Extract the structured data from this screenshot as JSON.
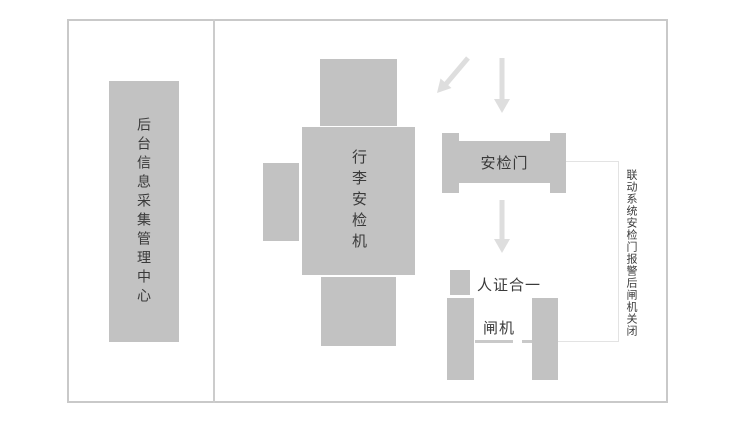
{
  "diagram": {
    "title_context": "security-check-flow-diagram",
    "left_panel": {
      "label": "后台信息采集管理中心"
    },
    "baggage_machine": {
      "label": "行李安检机"
    },
    "security_door": {
      "label": "安检门"
    },
    "id_verification": {
      "label": "人证合一"
    },
    "gate": {
      "label": "闸机"
    },
    "linkage_note": {
      "label": "联动系统安检门报警后闸机关闭"
    },
    "colors": {
      "shape_fill": "#c2c2c2",
      "arrow": "#dedede",
      "frame_border": "#c9c9c9",
      "connector_line": "#e3e3e3",
      "text": "#3a3a3a"
    }
  }
}
